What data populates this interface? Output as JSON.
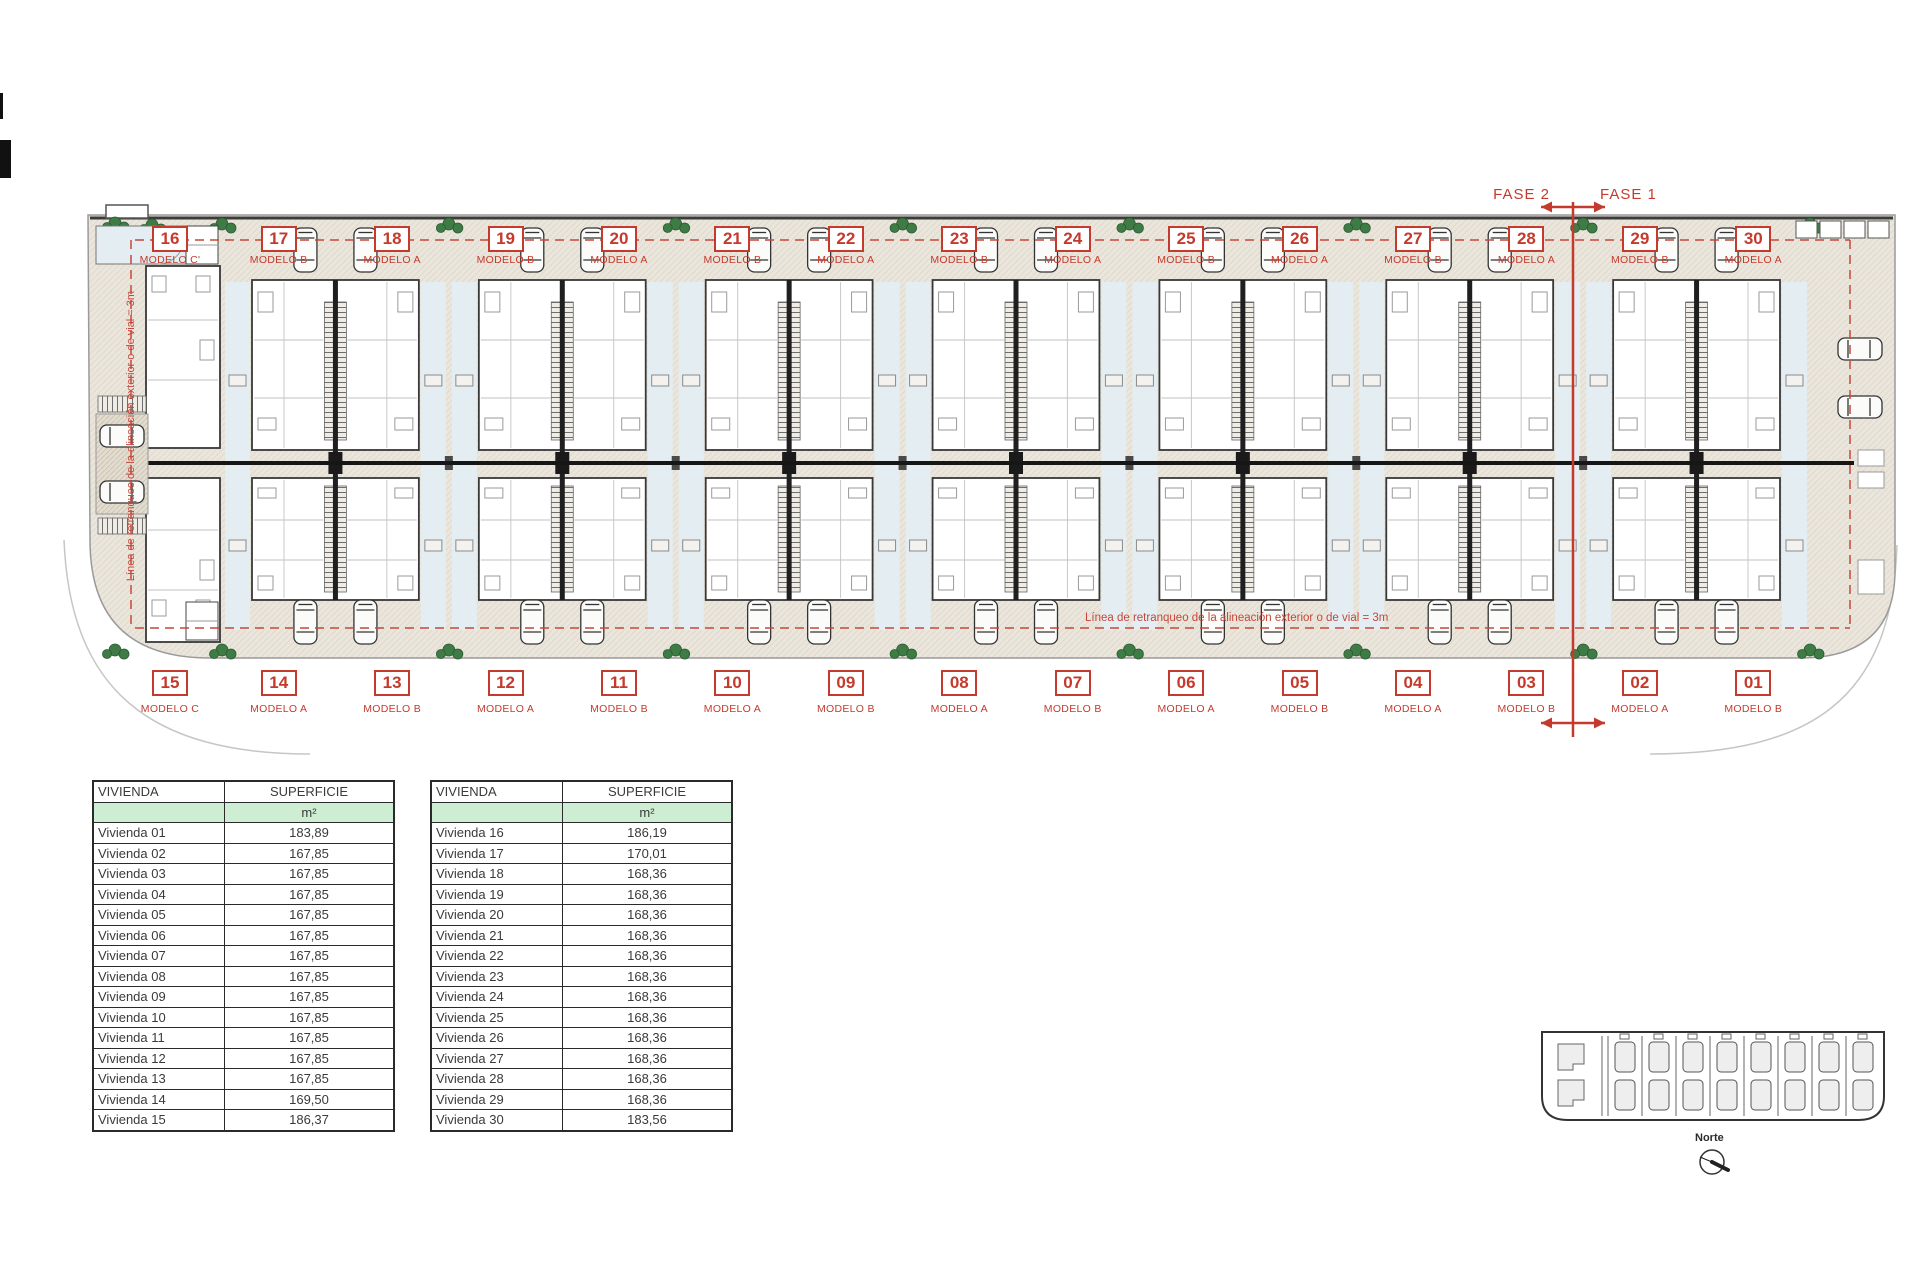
{
  "colors": {
    "accent_red": "#c43a2c",
    "table_green": "#cdeed3",
    "site_beige": "#ebe6dc",
    "patio_blue": "#e4edf2",
    "plant_green": "#3e7b45"
  },
  "site_plan": {
    "fase_left_label": "FASE 2",
    "fase_right_label": "FASE 1",
    "setback_note_horizontal": "Línea de retranqueo de la alineación exterior o de vial = 3m",
    "setback_note_vertical": "Línea de retranqueo de la alineación exterior o de vial = 3m",
    "top_row": [
      {
        "num": "16",
        "model": "MODELO C'"
      },
      {
        "num": "17",
        "model": "MODELO B"
      },
      {
        "num": "18",
        "model": "MODELO A"
      },
      {
        "num": "19",
        "model": "MODELO B"
      },
      {
        "num": "20",
        "model": "MODELO A"
      },
      {
        "num": "21",
        "model": "MODELO B"
      },
      {
        "num": "22",
        "model": "MODELO A"
      },
      {
        "num": "23",
        "model": "MODELO B"
      },
      {
        "num": "24",
        "model": "MODELO A"
      },
      {
        "num": "25",
        "model": "MODELO B"
      },
      {
        "num": "26",
        "model": "MODELO A"
      },
      {
        "num": "27",
        "model": "MODELO B"
      },
      {
        "num": "28",
        "model": "MODELO A"
      },
      {
        "num": "29",
        "model": "MODELO B"
      },
      {
        "num": "30",
        "model": "MODELO A"
      }
    ],
    "bottom_row": [
      {
        "num": "15",
        "model": "MODELO C"
      },
      {
        "num": "14",
        "model": "MODELO A"
      },
      {
        "num": "13",
        "model": "MODELO B"
      },
      {
        "num": "12",
        "model": "MODELO A"
      },
      {
        "num": "11",
        "model": "MODELO B"
      },
      {
        "num": "10",
        "model": "MODELO A"
      },
      {
        "num": "09",
        "model": "MODELO B"
      },
      {
        "num": "08",
        "model": "MODELO A"
      },
      {
        "num": "07",
        "model": "MODELO B"
      },
      {
        "num": "06",
        "model": "MODELO A"
      },
      {
        "num": "05",
        "model": "MODELO B"
      },
      {
        "num": "04",
        "model": "MODELO A"
      },
      {
        "num": "03",
        "model": "MODELO B"
      },
      {
        "num": "02",
        "model": "MODELO A"
      },
      {
        "num": "01",
        "model": "MODELO B"
      }
    ]
  },
  "tables": [
    {
      "col_headers": [
        "VIVIENDA",
        "SUPERFICIE"
      ],
      "unit_row": [
        "",
        "m²"
      ],
      "rows": [
        [
          "Vivienda 01",
          "183,89"
        ],
        [
          "Vivienda 02",
          "167,85"
        ],
        [
          "Vivienda 03",
          "167,85"
        ],
        [
          "Vivienda 04",
          "167,85"
        ],
        [
          "Vivienda 05",
          "167,85"
        ],
        [
          "Vivienda 06",
          "167,85"
        ],
        [
          "Vivienda 07",
          "167,85"
        ],
        [
          "Vivienda 08",
          "167,85"
        ],
        [
          "Vivienda 09",
          "167,85"
        ],
        [
          "Vivienda 10",
          "167,85"
        ],
        [
          "Vivienda 11",
          "167,85"
        ],
        [
          "Vivienda 12",
          "167,85"
        ],
        [
          "Vivienda 13",
          "167,85"
        ],
        [
          "Vivienda 14",
          "169,50"
        ],
        [
          "Vivienda 15",
          "186,37"
        ]
      ]
    },
    {
      "col_headers": [
        "VIVIENDA",
        "SUPERFICIE"
      ],
      "unit_row": [
        "",
        "m²"
      ],
      "rows": [
        [
          "Vivienda 16",
          "186,19"
        ],
        [
          "Vivienda 17",
          "170,01"
        ],
        [
          "Vivienda 18",
          "168,36"
        ],
        [
          "Vivienda 19",
          "168,36"
        ],
        [
          "Vivienda 20",
          "168,36"
        ],
        [
          "Vivienda 21",
          "168,36"
        ],
        [
          "Vivienda 22",
          "168,36"
        ],
        [
          "Vivienda 23",
          "168,36"
        ],
        [
          "Vivienda 24",
          "168,36"
        ],
        [
          "Vivienda 25",
          "168,36"
        ],
        [
          "Vivienda 26",
          "168,36"
        ],
        [
          "Vivienda 27",
          "168,36"
        ],
        [
          "Vivienda 28",
          "168,36"
        ],
        [
          "Vivienda 29",
          "168,36"
        ],
        [
          "Vivienda 30",
          "183,56"
        ]
      ]
    }
  ],
  "key_plan": {
    "north_label": "Norte"
  }
}
